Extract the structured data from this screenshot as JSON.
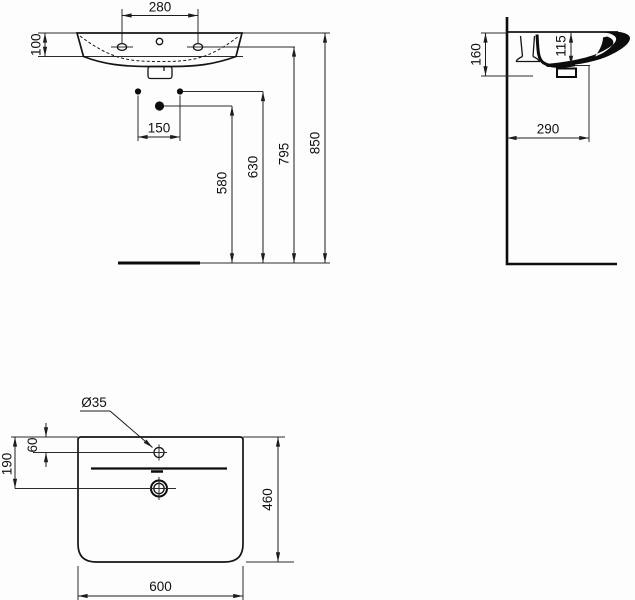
{
  "drawing": {
    "type": "washbasin technical dimension drawing",
    "views": {
      "front": {
        "name": "front elevation",
        "dimensions": {
          "tap_hole_spacing": "280",
          "rim_height": "100",
          "fixing_bolt_spacing": "150",
          "waste_outlet_height": "580",
          "fixing_bolt_height": "630",
          "tap_hole_height": "795",
          "rim_top_height": "850"
        }
      },
      "side": {
        "name": "side section",
        "dimensions": {
          "fixing_depth": "160",
          "inner_depth": "115",
          "waste_projection": "290"
        }
      },
      "plan": {
        "name": "plan view",
        "dimensions": {
          "tap_hole_diameter": "Ø35",
          "tap_hole_offset": "60",
          "waste_offset": "190",
          "basin_depth": "460",
          "basin_width": "600"
        }
      }
    },
    "colors": {
      "line": "#1d1d1d",
      "background": "#fdfdfd"
    }
  }
}
